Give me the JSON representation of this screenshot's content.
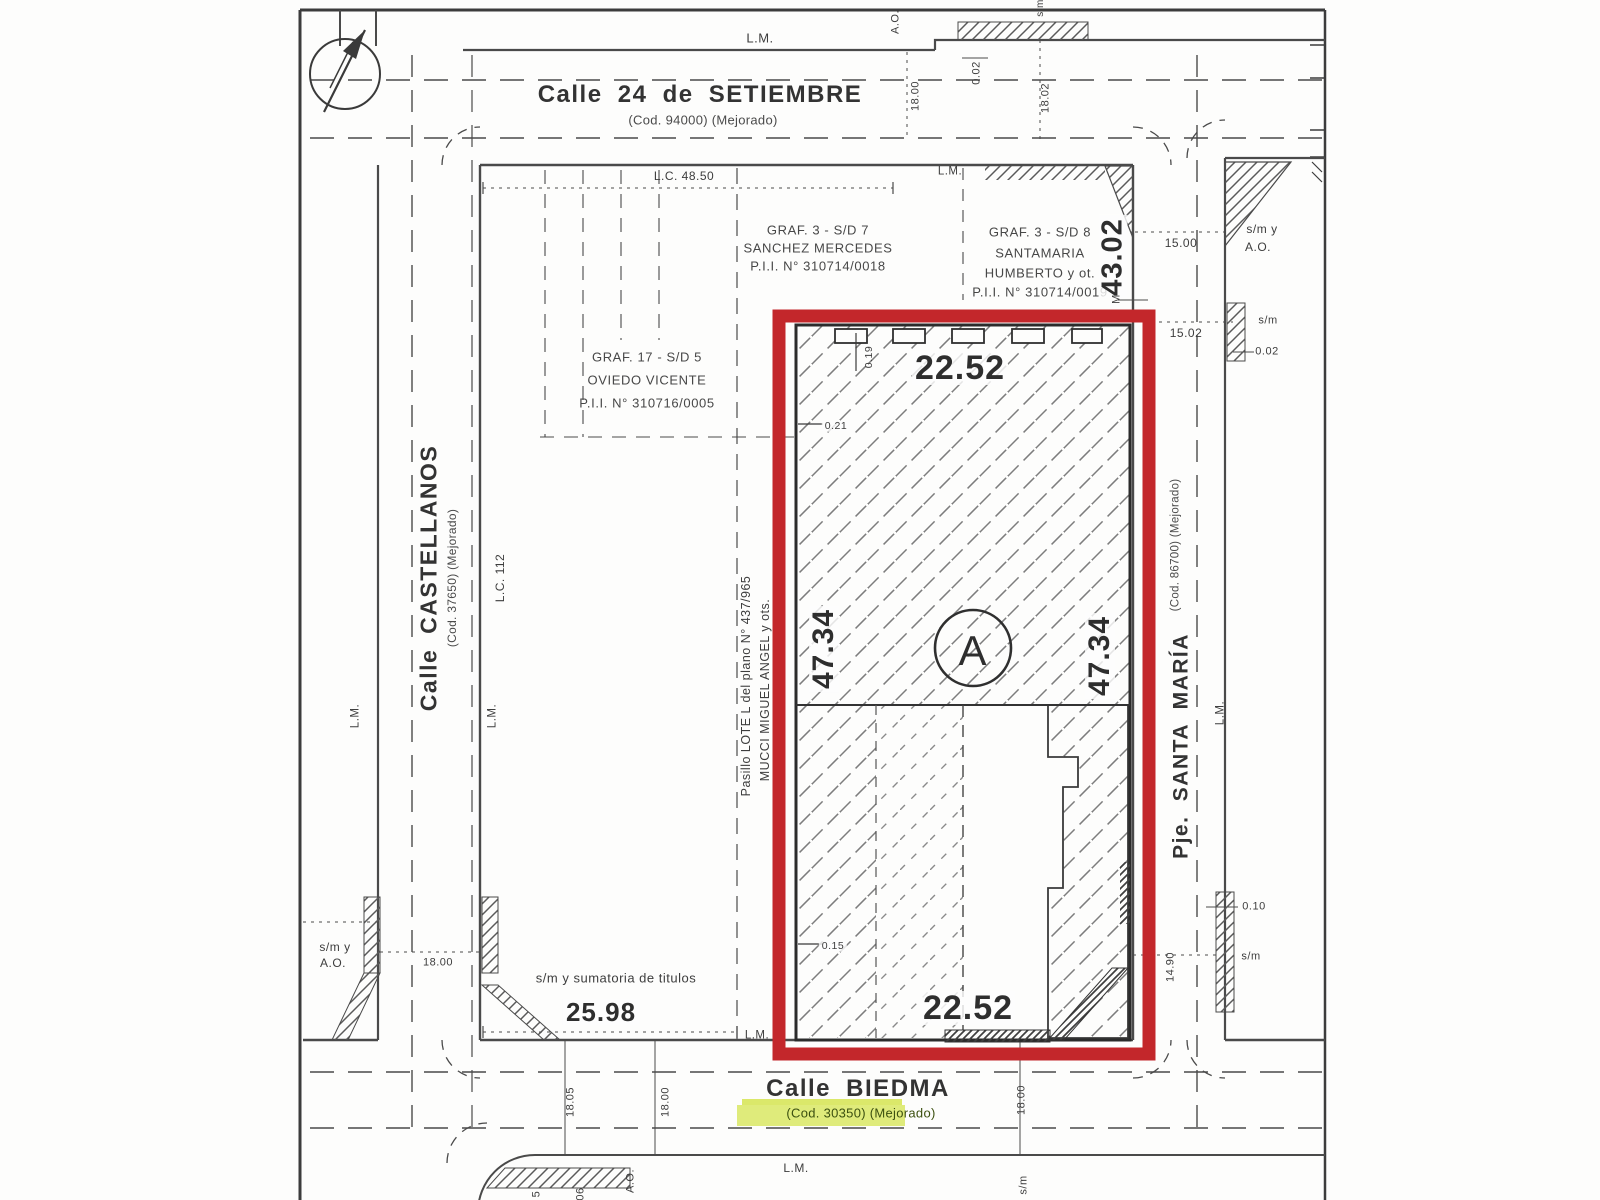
{
  "document": {
    "type": "cadastral survey plan (scan)",
    "subject_lot_letter": "A"
  },
  "colors": {
    "red_outline": "#c3272b",
    "highlight_yellow": "#d7e65a",
    "ink": "#3f3f3f",
    "paper": "#fdfdfc"
  },
  "labels": {
    "street_top_name": "Calle 24 de SETIEMBRE",
    "street_top_code": "(Cod. 94000) (Mejorado)",
    "street_left_name": "Calle CASTELLANOS",
    "street_left_code": "(Cod. 37650) (Mejorado)",
    "street_right_name": "Pje. SANTA MARÍA",
    "street_right_code": "(Cod. 86700) (Mejorado)",
    "street_bottom_name": "Calle BIEDMA",
    "street_bottom_code": "(Cod. 30350) (Mejorado)",
    "graf7_1": "GRAF. 3 - S/D 7",
    "graf7_2": "SANCHEZ MERCEDES",
    "graf7_3": "P.I.I. N° 310714/0018",
    "graf8_1": "GRAF. 3 - S/D 8",
    "graf8_2": "SANTAMARIA",
    "graf8_3": "HUMBERTO y ot.",
    "graf8_4": "P.I.I. N° 310714/0019",
    "graf17_1": "GRAF. 17 - S/D 5",
    "graf17_2": "OVIEDO VICENTE",
    "graf17_3": "P.I.I. N° 310716/0005",
    "pasillo_1": "Pasillo LOTE L   del plano N° 437/965",
    "pasillo_2": "MUCCI MIGUEL ANGEL y ots.",
    "lot_letter": "A",
    "dim_top": "22.52",
    "dim_bottom": "22.52",
    "dim_left": "47.34",
    "dim_right": "47.34",
    "dim_43_02": "43.02",
    "dim_0_19": "0.19",
    "dim_0_21": "0.21",
    "dim_0_15": "0.15",
    "dim_14_90": "14.90",
    "dim_15_00": "15.00",
    "dim_15_02": "15.02",
    "dim_0_02_east": "0.02",
    "dim_0_10": "0.10",
    "dim_18_00_top": "18.00",
    "dim_0_02_top": "0.02",
    "dim_18_02_top": "18.02",
    "dim_18_00_left": "18.00",
    "dim_18_05_biedma": "18.05",
    "dim_18_00_biedma_w": "18.00",
    "dim_18_00_biedma_e": "18.00",
    "dim_25_98": "25.98",
    "lc_48_50": "L.C.  48.50",
    "lc_112": "L.C.  112",
    "lm_top": "L.M.",
    "lm_block_top": "L.M.",
    "lm_left_1": "L.M.",
    "lm_left_2": "L.M.",
    "lm_right": "L.M.",
    "lm_biedma_north": "L.M.",
    "lm_bottom": "L.M.",
    "m_right_edge": "M",
    "sm_top": "s/m",
    "sm_right_1": "s/m",
    "sm_right_2": "s/m",
    "sm_biedma": "s/m",
    "ao_top": "A.O.",
    "ao_biedma": "A.O.",
    "smy_ao_left_1": "s/m y",
    "smy_ao_left_2": "A.O.",
    "smy_ao_right_1": "s/m y",
    "smy_ao_right_2": "A.O.",
    "sumatoria": "s/m y sumatoria de titulos",
    "bottom_fragment_1": "5",
    "bottom_fragment_2": "06"
  }
}
